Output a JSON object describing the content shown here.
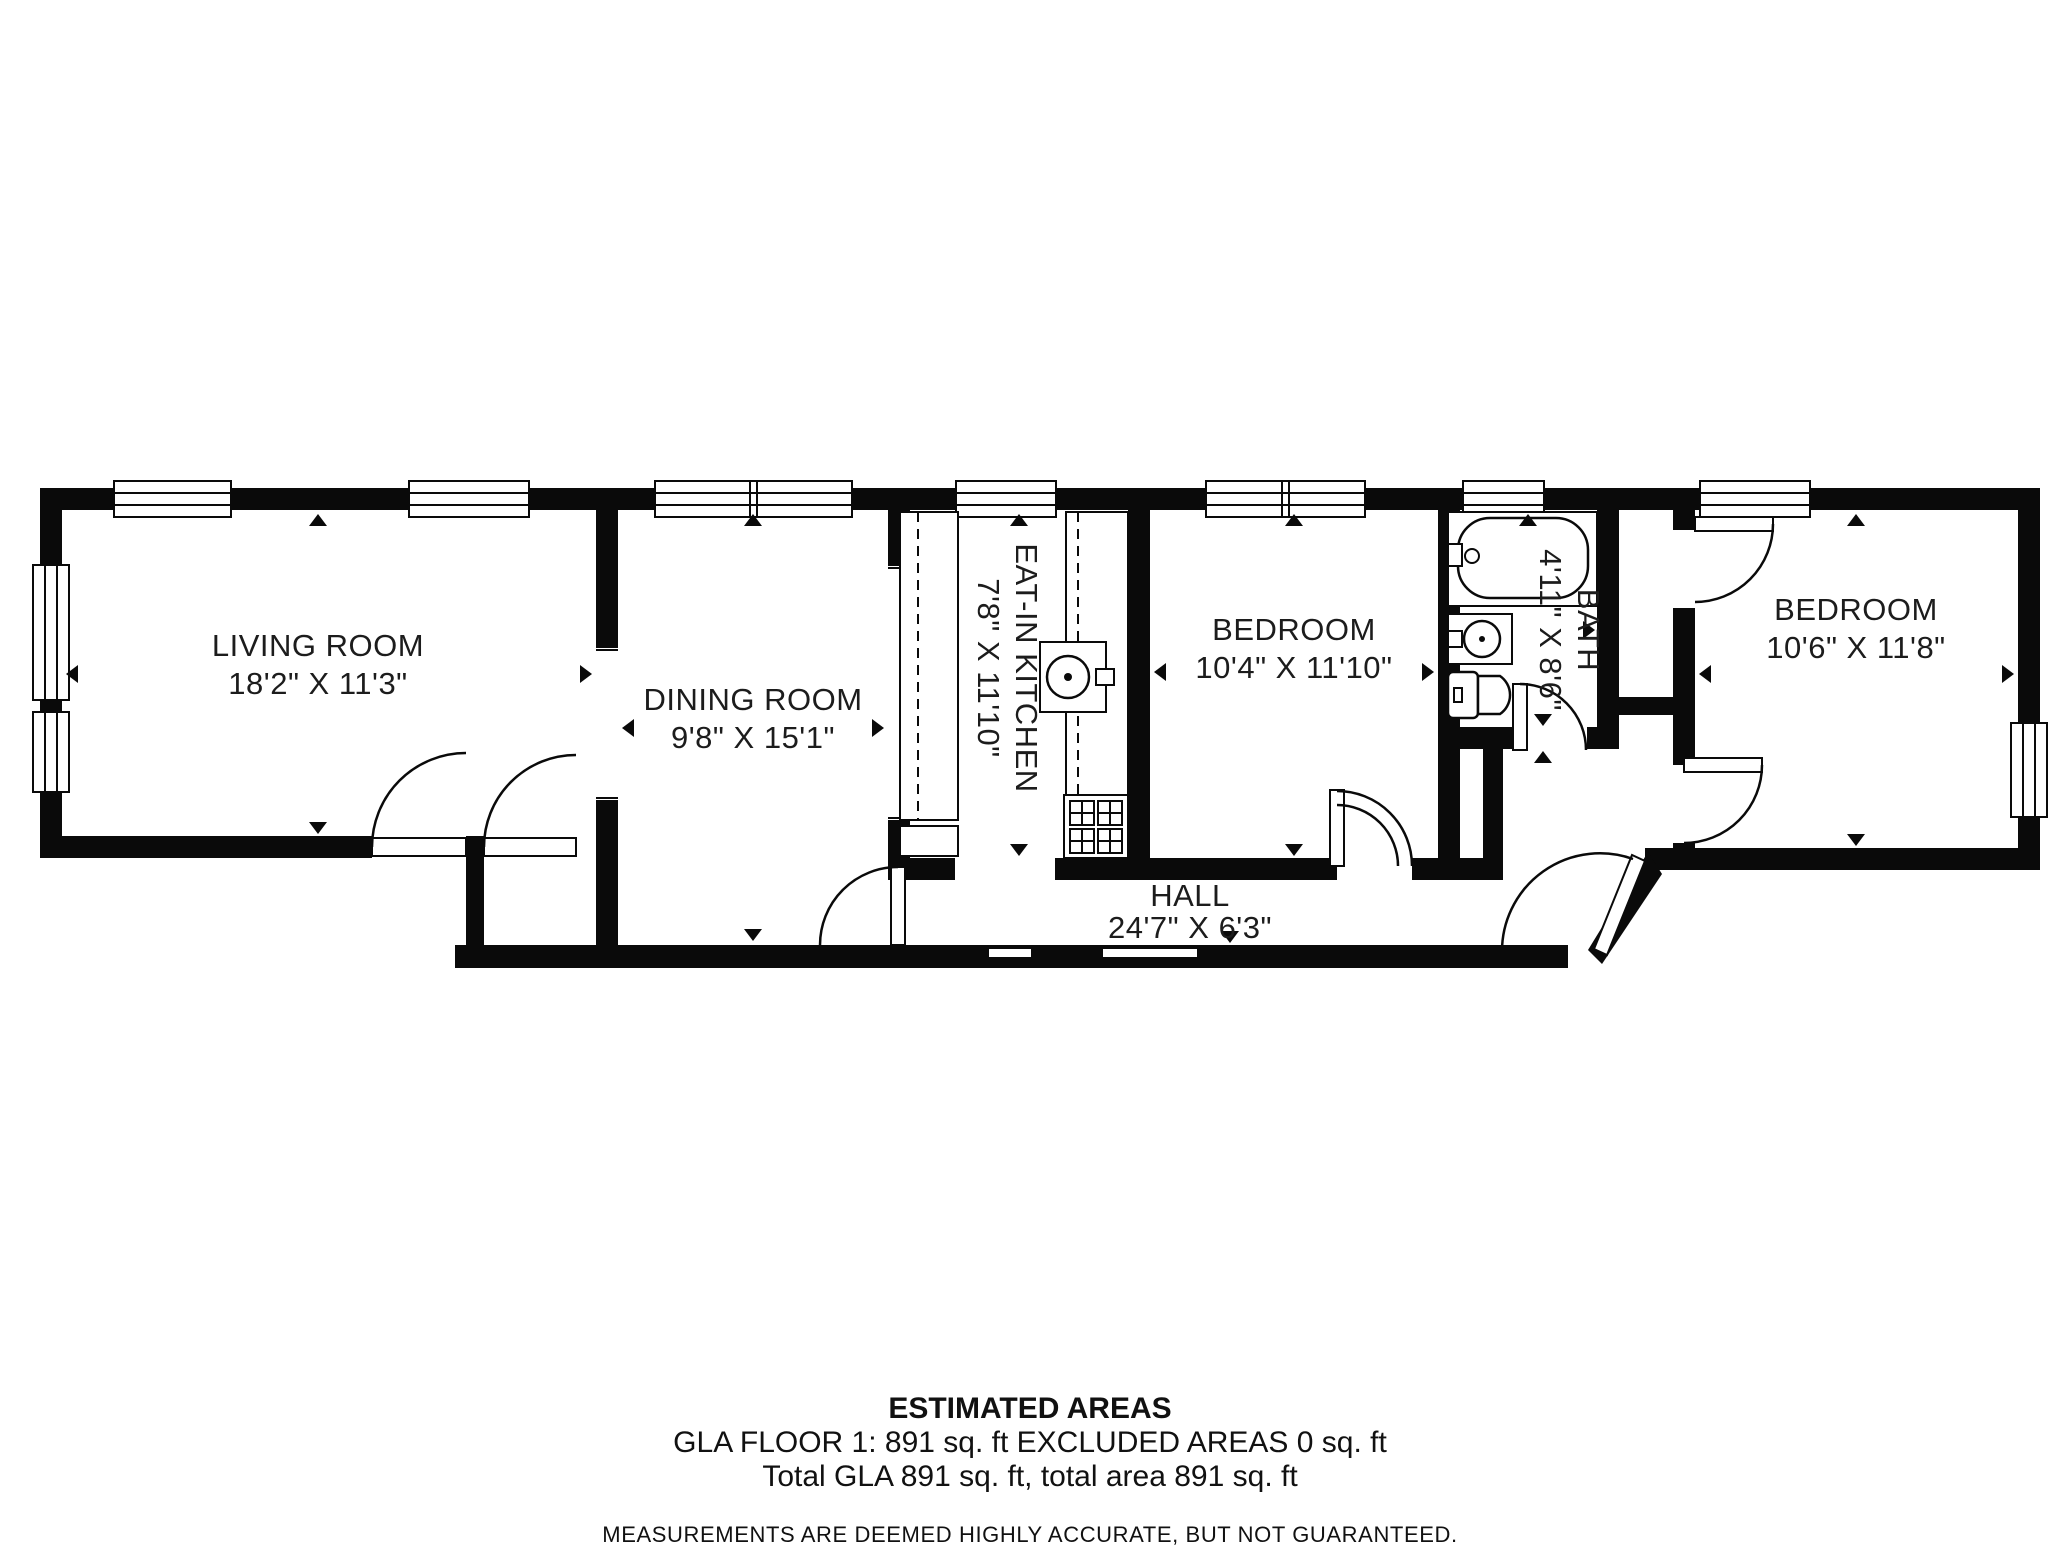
{
  "plan": {
    "rooms": {
      "living": {
        "name": "LIVING ROOM",
        "dims": "18'2\" X 11'3\""
      },
      "dining": {
        "name": "DINING ROOM",
        "dims": "9'8\" X 15'1\""
      },
      "kitchen": {
        "name": "EAT-IN KITCHEN",
        "dims": "7'8\" X 11'10\""
      },
      "bedroom1": {
        "name": "BEDROOM",
        "dims": "10'4\" X 11'10\""
      },
      "bath": {
        "name": "BATH",
        "dims": "4'11\" X 8'6\""
      },
      "bedroom2": {
        "name": "BEDROOM",
        "dims": "10'6\" X 11'8\""
      },
      "hall": {
        "name": "HALL",
        "dims": "24'7\" X 6'3\""
      }
    },
    "colors": {
      "wall": "#0a0a0a",
      "background": "#ffffff"
    }
  },
  "footer": {
    "title": "ESTIMATED AREAS",
    "line1": "GLA FLOOR 1: 891 sq. ft EXCLUDED AREAS 0 sq. ft",
    "line2": "Total GLA 891 sq. ft, total area 891 sq. ft",
    "disclaimer": "MEASUREMENTS ARE DEEMED HIGHLY ACCURATE, BUT NOT GUARANTEED."
  }
}
